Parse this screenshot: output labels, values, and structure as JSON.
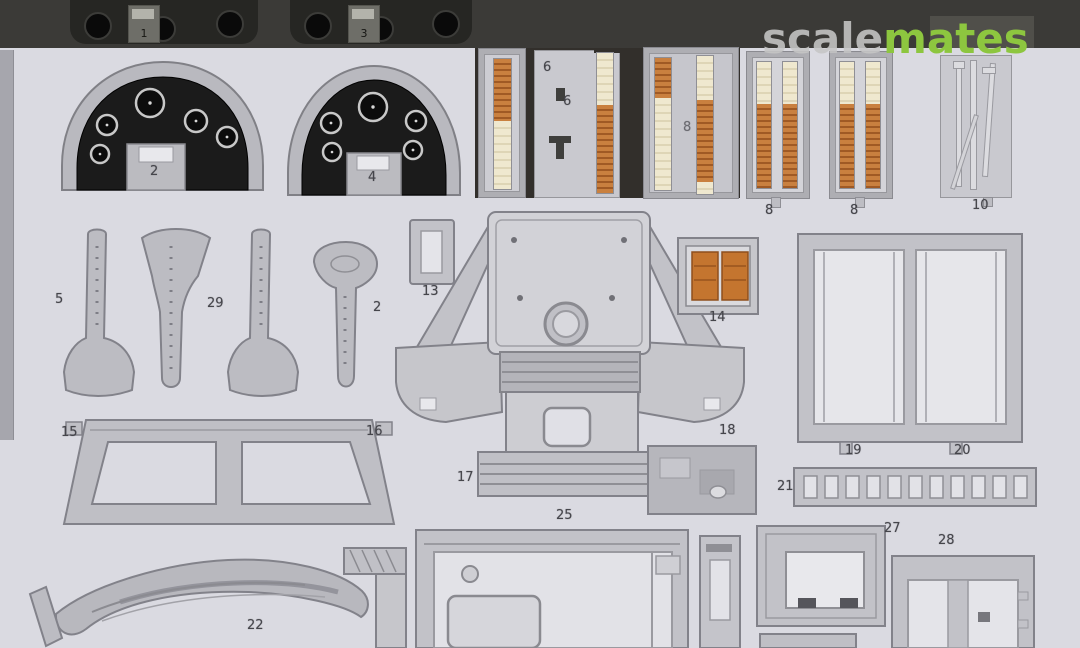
{
  "watermark": {
    "scale": "scale",
    "mates": "mates",
    "green": "#8dc63f"
  },
  "colors": {
    "background": "#dadae1",
    "sheet_metal": "#c6c6cb",
    "dark_strip": "#3a3937",
    "panel_black": "#1b1b1b",
    "belt_orange": "#c4763a",
    "belt_cream": "#ece4c8"
  },
  "labels": {
    "n1": "1",
    "n3": "3",
    "n2": "2",
    "n4": "4",
    "n6a": "6",
    "n6b": "6",
    "n8mid": "8",
    "n8a": "8",
    "n8b": "8",
    "n10": "10",
    "n5": "5",
    "n29": "29",
    "n2b": "2",
    "n13": "13",
    "n14": "14",
    "n15": "15",
    "n16": "16",
    "n17": "17",
    "n18": "18",
    "n19": "19",
    "n20": "20",
    "n21": "21",
    "n22": "22",
    "n25": "25",
    "n27": "27",
    "n28": "28"
  }
}
